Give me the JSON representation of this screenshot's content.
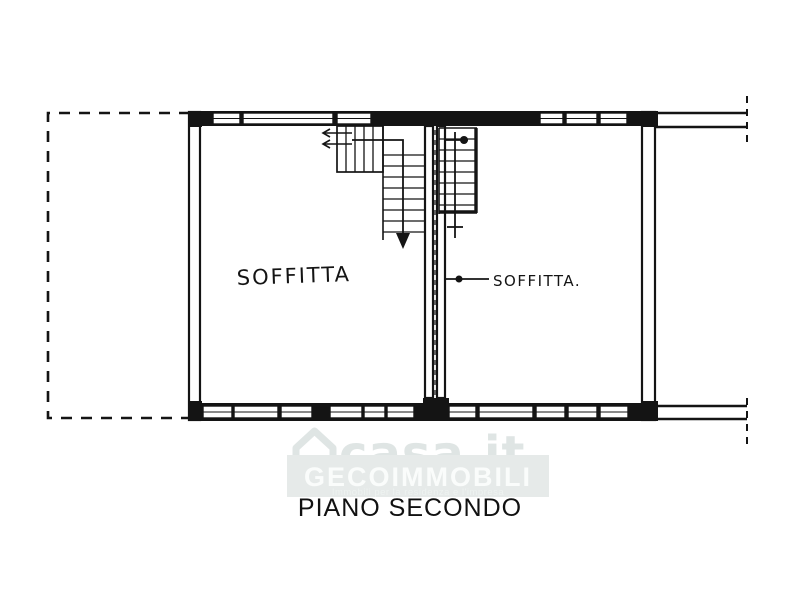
{
  "plan": {
    "title": "PIANO SECONDO",
    "room_left_label": "SOFFITTA",
    "room_right_label": "SOFFITTA."
  },
  "watermark": {
    "brand": "casa.it",
    "agency": "GECOIMMOBILI",
    "tagline": "Immobili per la residenza e l'impresa"
  },
  "colors": {
    "ink": "#141414",
    "title_text": "#111111",
    "watermark_brand": "#dfe5e4",
    "watermark_band": "#e6eae9",
    "watermark_text": "#fafcfb",
    "watermark_tagline": "#eef3f1"
  }
}
